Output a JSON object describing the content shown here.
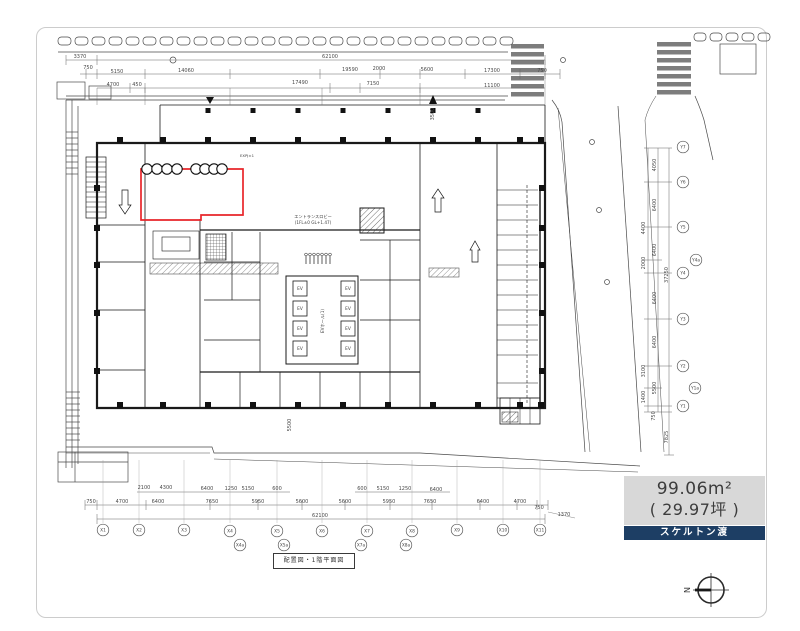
{
  "legend": {
    "area_m2": "99.06m²",
    "area_tsubo": "( 29.97坪 )",
    "handover": "スケルトン渡"
  },
  "title_block": {
    "text": "配置図・1階平面図"
  },
  "compass": {
    "north_letter": "N"
  },
  "colors": {
    "navy": "#1d3e64",
    "legend_gray": "#d8d8d8",
    "line": "#1a1a1a",
    "dim_text": "#4a4a4a",
    "highlight_red": "#e8252a"
  },
  "plan_annotations": [
    {
      "text": "エントランスロビー",
      "x": 313,
      "y": 218,
      "size": 4.2
    },
    {
      "text": "(1FL±0 GL+1.47)",
      "x": 313,
      "y": 224,
      "size": 4.2
    },
    {
      "text": "EVホール(1)",
      "x": 324,
      "y": 321,
      "size": 4.2,
      "rot": -90
    },
    {
      "text": "EXPJ±1",
      "x": 247,
      "y": 157,
      "size": 3.8
    }
  ],
  "elevators": {
    "label": "EV",
    "positions": [
      [
        293,
        281
      ],
      [
        293,
        301
      ],
      [
        293,
        321
      ],
      [
        293,
        341
      ],
      [
        341,
        281
      ],
      [
        341,
        301
      ],
      [
        341,
        321
      ],
      [
        341,
        341
      ]
    ],
    "w": 14,
    "h": 15
  },
  "highlight": {
    "color": "#e8252a",
    "outline": "M141,169 H243 V215 H201 V220 H141 Z",
    "circle_rows": [
      [
        147,
        157,
        167,
        177
      ],
      [
        196,
        205,
        214,
        222
      ]
    ],
    "cy": 169,
    "r": 5.2
  },
  "dimensions": {
    "top": [
      {
        "t": "3370",
        "x": 80,
        "y": 58
      },
      {
        "t": "62100",
        "x": 330,
        "y": 58
      },
      {
        "t": "750",
        "x": 88,
        "y": 69
      },
      {
        "t": "5150",
        "x": 117,
        "y": 73
      },
      {
        "t": "14060",
        "x": 186,
        "y": 72
      },
      {
        "t": "19590",
        "x": 350,
        "y": 71
      },
      {
        "t": "2000",
        "x": 379,
        "y": 70
      },
      {
        "t": "5600",
        "x": 427,
        "y": 71
      },
      {
        "t": "17300",
        "x": 492,
        "y": 72
      },
      {
        "t": "750",
        "x": 542,
        "y": 72
      },
      {
        "t": "4700",
        "x": 113,
        "y": 86
      },
      {
        "t": "450",
        "x": 137,
        "y": 86
      },
      {
        "t": "17490",
        "x": 300,
        "y": 84
      },
      {
        "t": "7150",
        "x": 373,
        "y": 85
      },
      {
        "t": "11100",
        "x": 492,
        "y": 87
      }
    ],
    "bottom": [
      {
        "t": "2100",
        "x": 144,
        "y": 489
      },
      {
        "t": "4300",
        "x": 166,
        "y": 489
      },
      {
        "t": "6400",
        "x": 207,
        "y": 490
      },
      {
        "t": "1250",
        "x": 231,
        "y": 490
      },
      {
        "t": "5150",
        "x": 248,
        "y": 490
      },
      {
        "t": "600",
        "x": 277,
        "y": 490
      },
      {
        "t": "600",
        "x": 362,
        "y": 490
      },
      {
        "t": "5150",
        "x": 383,
        "y": 490
      },
      {
        "t": "1250",
        "x": 405,
        "y": 490
      },
      {
        "t": "6400",
        "x": 436,
        "y": 491
      },
      {
        "t": "750",
        "x": 91,
        "y": 503
      },
      {
        "t": "4700",
        "x": 122,
        "y": 503
      },
      {
        "t": "6400",
        "x": 158,
        "y": 503
      },
      {
        "t": "7650",
        "x": 212,
        "y": 503
      },
      {
        "t": "5950",
        "x": 258,
        "y": 503
      },
      {
        "t": "5600",
        "x": 302,
        "y": 503
      },
      {
        "t": "5600",
        "x": 345,
        "y": 503
      },
      {
        "t": "5950",
        "x": 389,
        "y": 503
      },
      {
        "t": "7650",
        "x": 430,
        "y": 503
      },
      {
        "t": "6400",
        "x": 483,
        "y": 503
      },
      {
        "t": "4700",
        "x": 520,
        "y": 503
      },
      {
        "t": "750",
        "x": 539,
        "y": 509
      },
      {
        "t": "62100",
        "x": 320,
        "y": 517
      },
      {
        "t": "1370",
        "x": 564,
        "y": 516
      }
    ],
    "right": [
      {
        "t": "4050",
        "x": 656,
        "y": 165,
        "rot": -90
      },
      {
        "t": "6400",
        "x": 656,
        "y": 205,
        "rot": -90
      },
      {
        "t": "4400",
        "x": 645,
        "y": 228,
        "rot": -90
      },
      {
        "t": "6400",
        "x": 656,
        "y": 250,
        "rot": -90
      },
      {
        "t": "2000",
        "x": 645,
        "y": 263,
        "rot": -90
      },
      {
        "t": "6400",
        "x": 656,
        "y": 298,
        "rot": -90
      },
      {
        "t": "6400",
        "x": 656,
        "y": 342,
        "rot": -90
      },
      {
        "t": "3100",
        "x": 645,
        "y": 371,
        "rot": -90
      },
      {
        "t": "5500",
        "x": 656,
        "y": 388,
        "rot": -90
      },
      {
        "t": "1400",
        "x": 645,
        "y": 397,
        "rot": -90
      },
      {
        "t": "750",
        "x": 655,
        "y": 416,
        "rot": -90
      },
      {
        "t": "37250",
        "x": 668,
        "y": 275,
        "rot": -90
      },
      {
        "t": "7825",
        "x": 668,
        "y": 437,
        "rot": -90
      }
    ],
    "misc": [
      {
        "t": "5500",
        "x": 291,
        "y": 425,
        "rot": -90
      },
      {
        "t": "3500",
        "x": 434,
        "y": 114,
        "rot": -90
      }
    ]
  },
  "grid_bubbles": {
    "bottom": [
      {
        "label": "X1",
        "x": 103,
        "y": 530
      },
      {
        "label": "X2",
        "x": 139,
        "y": 530
      },
      {
        "label": "X3",
        "x": 184,
        "y": 530
      },
      {
        "label": "X4",
        "x": 230,
        "y": 531
      },
      {
        "label": "X4a",
        "x": 240,
        "y": 545
      },
      {
        "label": "X5",
        "x": 277,
        "y": 531
      },
      {
        "label": "X5a",
        "x": 284,
        "y": 545
      },
      {
        "label": "X6",
        "x": 322,
        "y": 531
      },
      {
        "label": "X7",
        "x": 367,
        "y": 531
      },
      {
        "label": "X7a",
        "x": 361,
        "y": 545
      },
      {
        "label": "X8",
        "x": 412,
        "y": 531
      },
      {
        "label": "X8a",
        "x": 406,
        "y": 545
      },
      {
        "label": "X9",
        "x": 457,
        "y": 530
      },
      {
        "label": "X10",
        "x": 503,
        "y": 530
      },
      {
        "label": "X11",
        "x": 540,
        "y": 530
      }
    ],
    "right": [
      {
        "label": "Y7",
        "x": 683,
        "y": 147
      },
      {
        "label": "Y6",
        "x": 683,
        "y": 182
      },
      {
        "label": "Y5",
        "x": 683,
        "y": 227
      },
      {
        "label": "Y4a",
        "x": 696,
        "y": 260
      },
      {
        "label": "Y4",
        "x": 683,
        "y": 273
      },
      {
        "label": "Y3",
        "x": 683,
        "y": 319
      },
      {
        "label": "Y2",
        "x": 683,
        "y": 366
      },
      {
        "label": "Y1a",
        "x": 695,
        "y": 388
      },
      {
        "label": "Y1",
        "x": 683,
        "y": 406
      }
    ]
  }
}
